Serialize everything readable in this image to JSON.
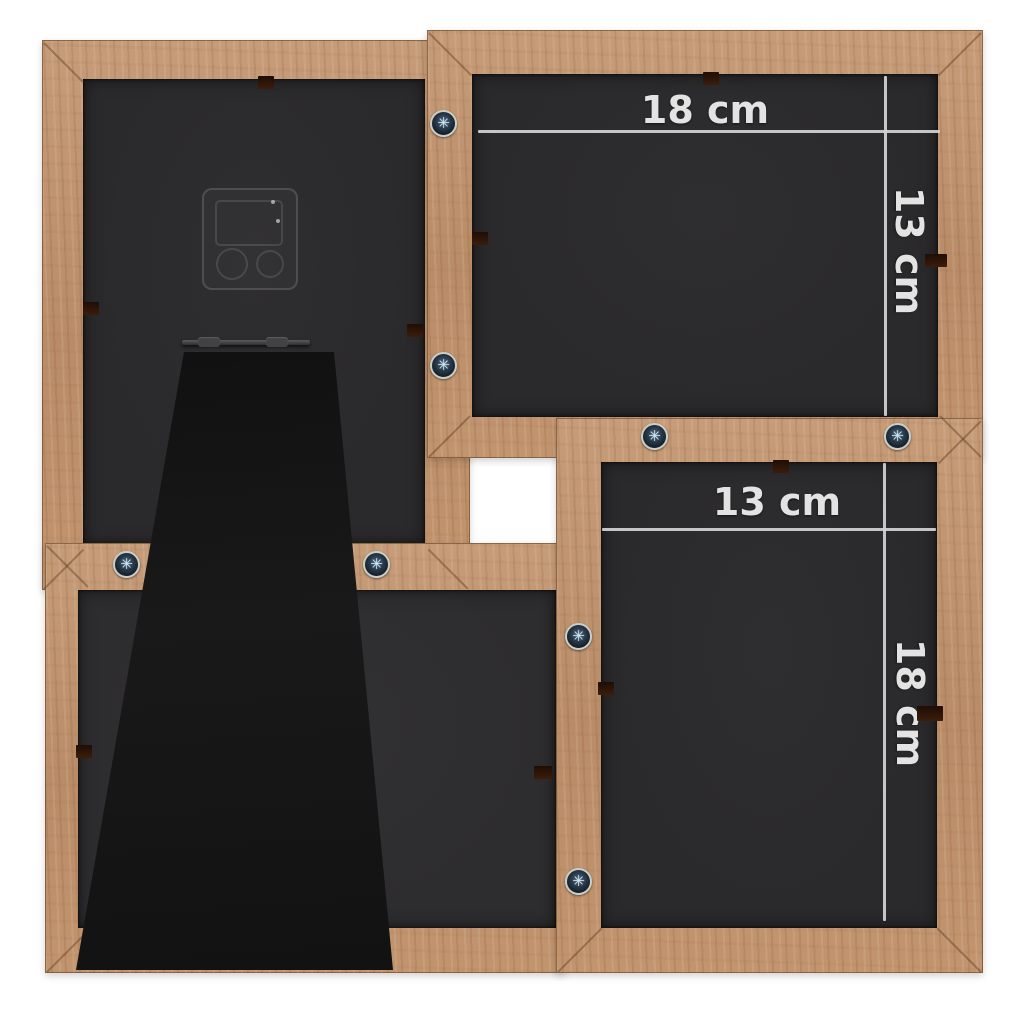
{
  "annotations": {
    "top_right_frame": {
      "width_label": "18 cm",
      "height_label": "13 cm"
    },
    "bottom_right_frame": {
      "width_label": "13 cm",
      "height_label": "18 cm"
    }
  },
  "colors": {
    "background": "#ffffff",
    "wood": "#bc9170",
    "wood_grain_dark": "#8d6540",
    "backing_panel": "#2a292b",
    "easel_stand": "#161616",
    "dimension_line": "#d2d2d2",
    "dimension_text": "#e3e3e3",
    "screw_ring": "#1f2c39",
    "screw_center": "#cfe4ec",
    "backing_clip": "#33190a"
  }
}
